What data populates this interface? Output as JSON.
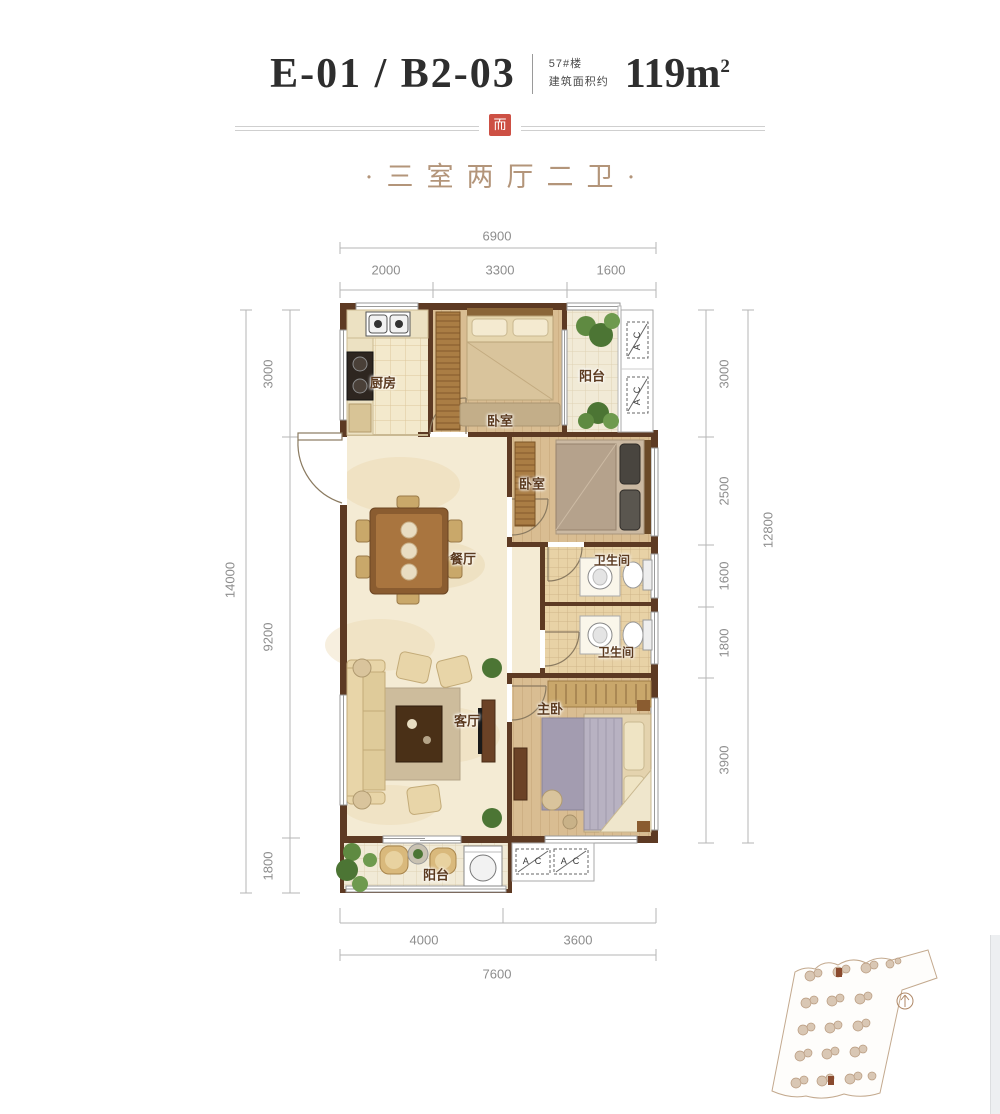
{
  "header": {
    "unit_code": "E-01 / B2-03",
    "building_no": "57#楼",
    "area_label": "建筑面积约",
    "area_value": "119m",
    "area_sup": "2",
    "subtitle": "·三室两厅二卫·"
  },
  "dimensions": {
    "top": {
      "total": "6900",
      "segments": [
        "2000",
        "3300",
        "1600"
      ]
    },
    "bottom": {
      "total": "7600",
      "segments": [
        "4000",
        "3600"
      ]
    },
    "left": {
      "total": "14000",
      "segments": [
        "3000",
        "9200",
        "1800"
      ]
    },
    "right": {
      "total": "12800",
      "segments": [
        "3000",
        "2500",
        "1600",
        "1800",
        "3900"
      ]
    }
  },
  "rooms": {
    "kitchen": "厨房",
    "bedroom_top": "卧室",
    "balcony_top": "阳台",
    "bedroom_mid": "卧室",
    "bath_upper": "卫生间",
    "bath_lower": "卫生间",
    "dining": "餐厅",
    "living": "客厅",
    "master": "主卧",
    "balcony_bottom": "阳台"
  },
  "labels": {
    "ac": "A C"
  },
  "colors": {
    "wall": "#5d3a23",
    "seal_red": "#cd5044",
    "subtitle_tan": "#b3957a",
    "dim_gray": "#8d8d8d"
  }
}
